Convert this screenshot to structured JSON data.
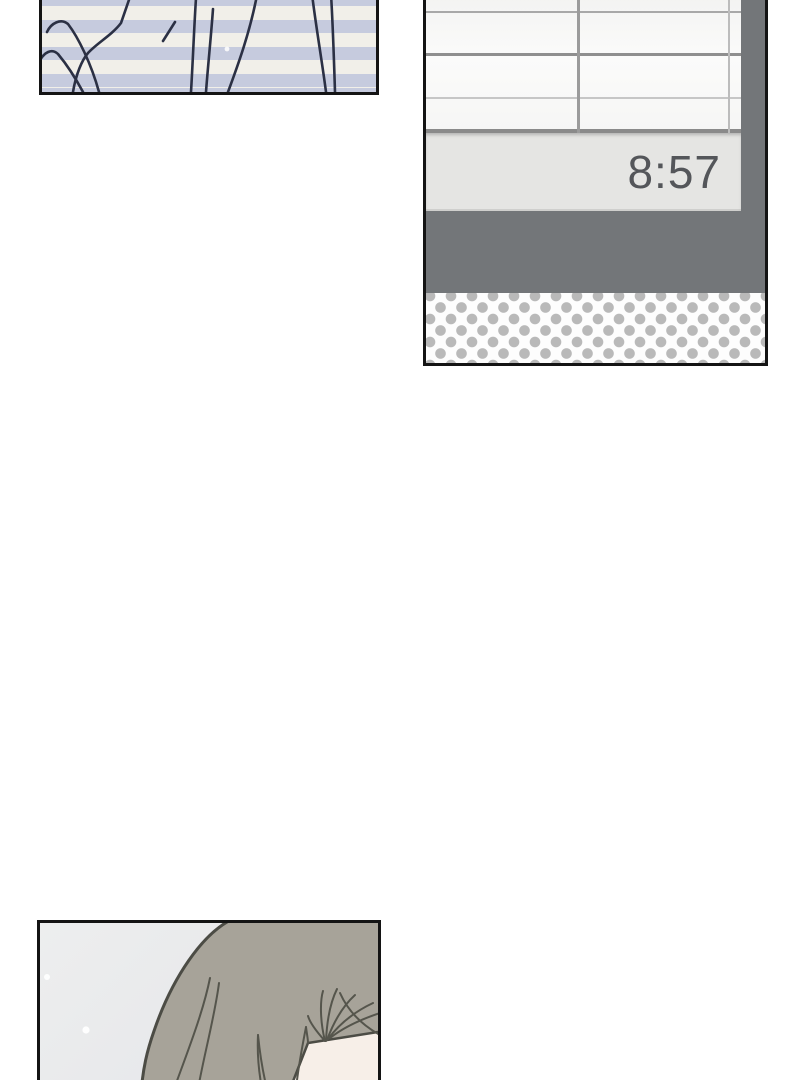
{
  "page": {
    "background": "#ffffff",
    "description": "comic page with three panels"
  },
  "panels": {
    "striped": {
      "label": "striped-fabric-closeup",
      "stripe_color_a": "#c6cbde",
      "stripe_color_b": "#f1efe9",
      "line_art_color": "#2b3044"
    },
    "clock": {
      "time": "8:57",
      "time_color": "#54565a",
      "clock_bar_color": "#e5e5e3",
      "window_pane_color": "#fafaf9",
      "window_grid_color": "#9a9a9a",
      "wall_color": "#737679",
      "halftone_dot_color": "#b9b9b9",
      "halftone_background": "#fdfdfd"
    },
    "character": {
      "label": "character-head-closeup",
      "background_color": "#e8e9eb",
      "hair_color": "#a7a399",
      "hair_line_color": "#4c4c45",
      "skin_color": "#f7efe8"
    }
  }
}
